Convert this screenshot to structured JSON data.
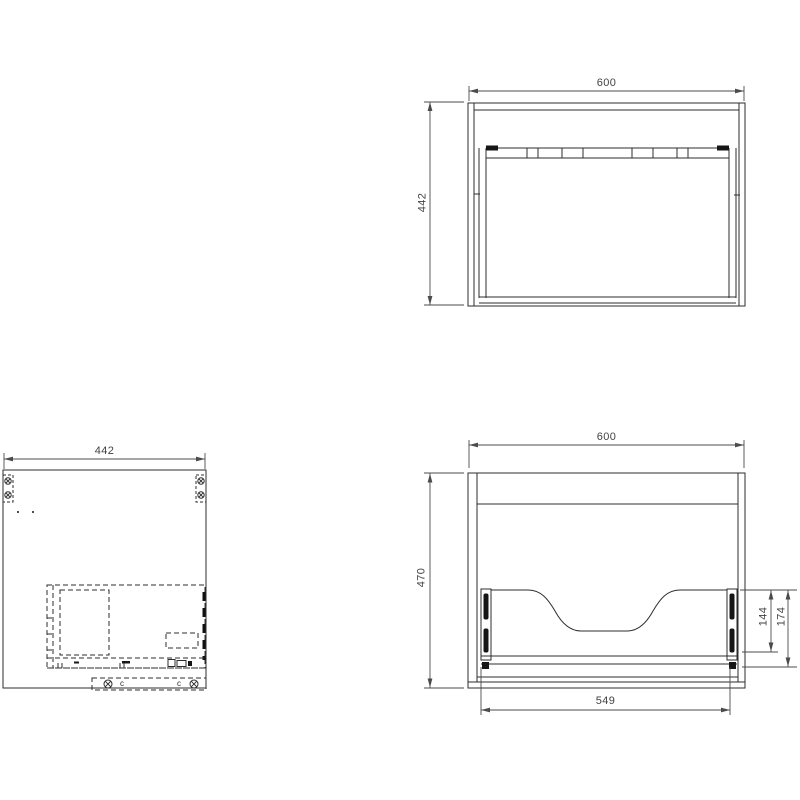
{
  "drawing": {
    "background": "#ffffff",
    "line_color": "#2d2d2d",
    "dimension_color": "#4b4b4b",
    "text_color": "#424242",
    "views": {
      "plan": {
        "name": "plan view (top)",
        "width_dim": "600",
        "depth_dim": "442"
      },
      "side": {
        "name": "side view",
        "depth_dim": "442",
        "cam_labels": [
          "c",
          "c"
        ]
      },
      "rear": {
        "name": "rear view",
        "width_dim": "600",
        "height_dim": "470",
        "drawer_width_dim": "549",
        "slide_inner_dim": "144",
        "slide_outer_dim": "174"
      }
    }
  }
}
